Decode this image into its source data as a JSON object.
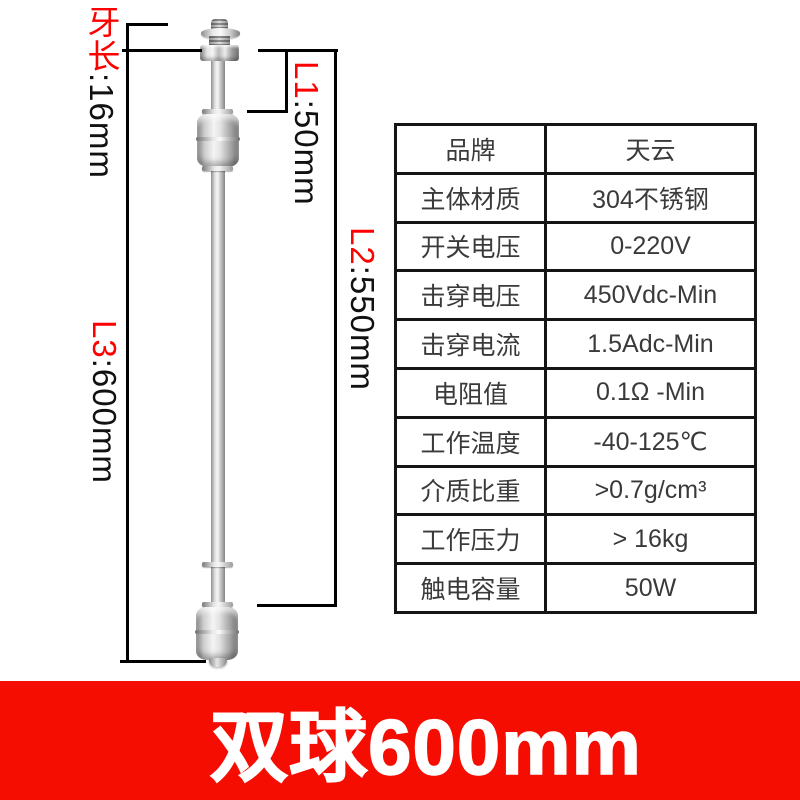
{
  "diagram": {
    "dim_thread": {
      "red": "牙长",
      "black": ":16mm"
    },
    "dim_l1": {
      "red": "L1",
      "black": ":50mm"
    },
    "dim_l2": {
      "red": "L2",
      "black": ":550mm"
    },
    "dim_l3": {
      "red": "L3",
      "black": ":600mm"
    },
    "label_red_color": "#fe0000",
    "line_color": "#000000"
  },
  "spec_table": {
    "rows": [
      {
        "label": "品牌",
        "value": "天云"
      },
      {
        "label": "主体材质",
        "value": "304不锈钢"
      },
      {
        "label": "开关电压",
        "value": "0-220V"
      },
      {
        "label": "击穿电压",
        "value": "450Vdc-Min"
      },
      {
        "label": "击穿电流",
        "value": "1.5Adc-Min"
      },
      {
        "label": "电阻值",
        "value": "0.1Ω -Min"
      },
      {
        "label": "工作温度",
        "value": "-40-125℃"
      },
      {
        "label": "介质比重",
        "value": ">0.7g/cm³"
      },
      {
        "label": "工作压力",
        "value": "> 16kg"
      },
      {
        "label": "触电容量",
        "value": "50W"
      }
    ]
  },
  "banner": {
    "title": "双球600mm",
    "bg_color": "#f40d00",
    "text_color": "#ffffff"
  }
}
